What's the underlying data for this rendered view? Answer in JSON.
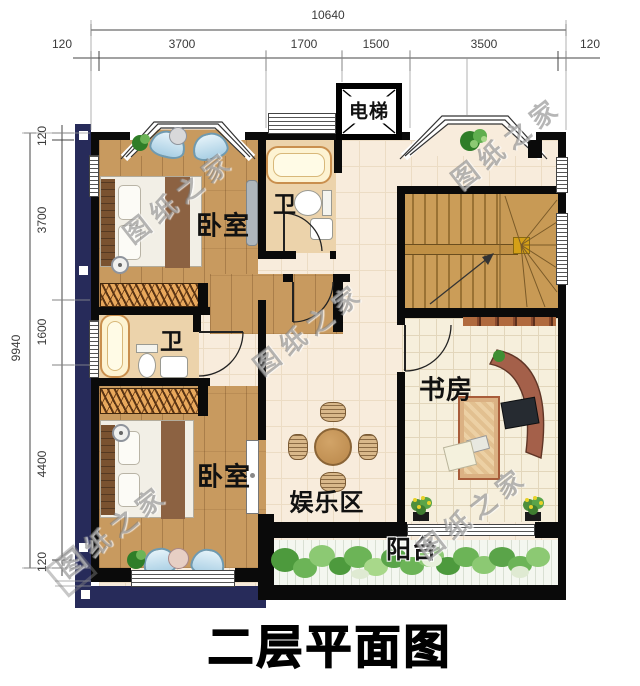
{
  "title": "二层平面图",
  "watermark_text": "图纸之家",
  "rooms": {
    "elevator": "电梯",
    "bedroom_top": "卧室",
    "bath_top": "卫",
    "bath_mid": "卫",
    "bedroom_bottom": "卧室",
    "study": "书房",
    "entertainment": "娱乐区",
    "balcony": "阳台"
  },
  "dimensions": {
    "top": {
      "total": "10640",
      "segments": [
        "120",
        "3700",
        "1700",
        "1500",
        "3500",
        "120"
      ]
    },
    "left": {
      "total": "9940",
      "segments": [
        "120",
        "3700",
        "1600",
        "4400",
        "120"
      ]
    }
  },
  "colors": {
    "wall": "#0a0a0a",
    "shadow": "#272b5a",
    "wood_floor": "#c89a5f",
    "tile_floor": "#f8ecdc",
    "bath_floor": "#ecd3ab",
    "greenery": "#5aa449"
  }
}
